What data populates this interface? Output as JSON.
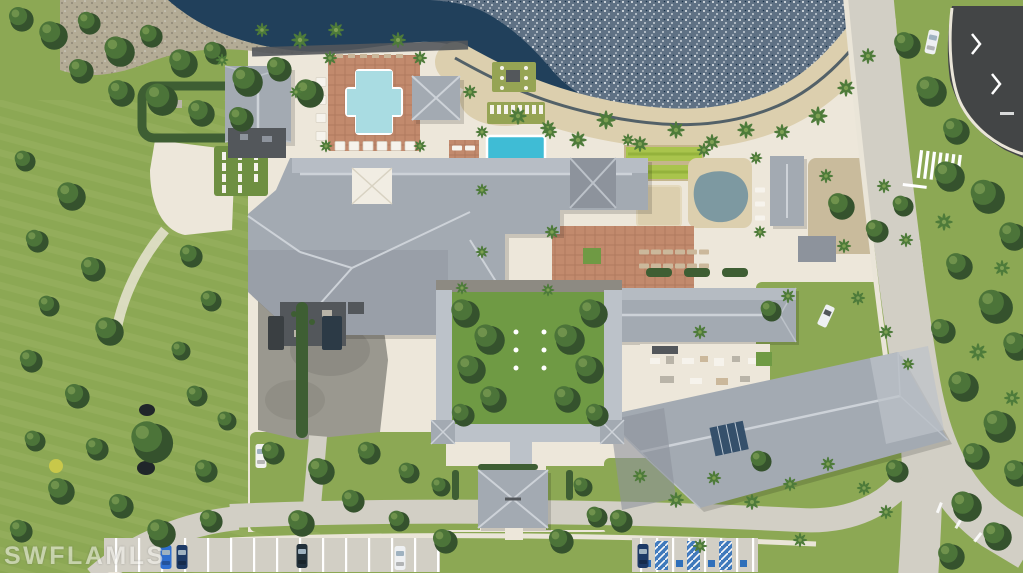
{
  "image": {
    "width": 1023,
    "height": 573,
    "kind": "aerial-drone-photo"
  },
  "watermark": {
    "text": "SWFLAMLS"
  },
  "palette": {
    "grass_base": "#8CA854",
    "grass_dark": "#6E8F41",
    "grass_light": "#A3BA6B",
    "courtyard_grass": "#6F9A44",
    "turf": "#96A454",
    "bocce": "#A9C44C",
    "bocce_dark": "#94B23C",
    "tree_dark": "#35522D",
    "tree_mid": "#4C7439",
    "tree_light": "#7FA054",
    "palm_green": "#4E7B3A",
    "hedge": "#3E5E33",
    "lake": "#21405B",
    "lake_deep": "#18324A",
    "sparkle_base": "#5F7184",
    "sparkle_dot": "#E8EDF1",
    "sand": "#DCCFAE",
    "gravel": "#B3AB95",
    "gravel_dot": "#8F8878",
    "dirt": "#C9BB9C",
    "concrete": "#EDE7DA",
    "road": "#D2CFC5",
    "sidewalk": "#EAE5D8",
    "asphalt_dark": "#434546",
    "service_asphalt": "#9A988F",
    "service_dark": "#84827A",
    "paver_dark": "#8D8A82",
    "roof_mid": "#A3AAB2",
    "roof_light": "#BCC2C9",
    "roof_lighter": "#CDD2D8",
    "roof_dark": "#8D939C",
    "roof_charcoal": "#53575B",
    "skylight_white": "#F1EDE3",
    "glass_blue": "#35506B",
    "pool_main": "#3FBCD5",
    "pool_main_light": "#8EE4E8",
    "pool_spa": "#A9DCE2",
    "lagoon": "#7D99A1",
    "pool_coping": "#FFFFFF",
    "brick": "#C28A6D",
    "brick_dark": "#B07A5F",
    "brick_light": "#C98F6F",
    "white_furniture": "#F6F3EC",
    "tan_furniture": "#CBB89B",
    "gray_furniture": "#B9B4A8",
    "marking": "#FFFFFF",
    "handicap_blue": "#2F6FBA",
    "car_blue": "#2F6FD0",
    "car_navy": "#1D3A66",
    "car_dark": "#22303A",
    "car_white": "#EEF0F2",
    "car_glass": "#9FB2C0",
    "van_white": "#F2F2F0",
    "truck_dark": "#3A3F42",
    "truck_blue": "#2C3A46",
    "pond": "#20262A",
    "flower_yellow": "#C8C84A",
    "watermark_text": "#F7F6F2"
  }
}
